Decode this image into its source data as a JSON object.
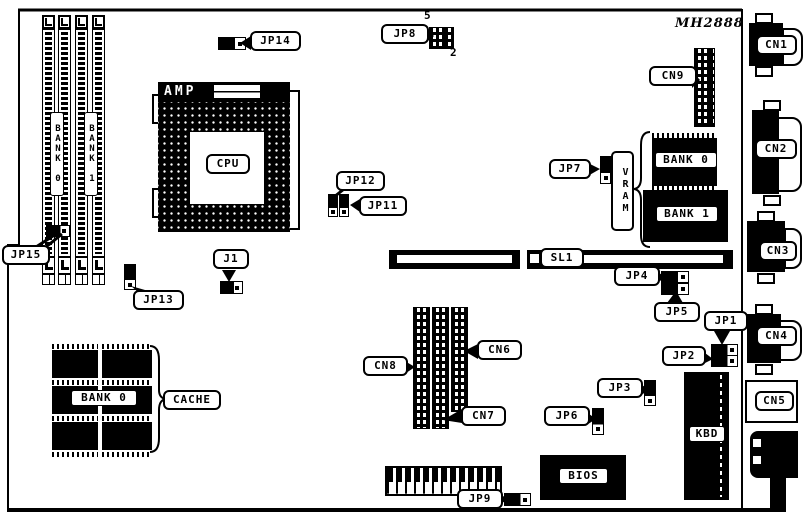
{
  "board": {
    "part_number": "MH2888",
    "cpu": {
      "socket_maker": "AMP",
      "label": "CPU"
    },
    "simm": {
      "bank0": "BANK 0",
      "bank1": "BANK 1"
    },
    "vram": {
      "label": "VRAM",
      "bank0": "BANK 0",
      "bank1": "BANK 1"
    },
    "cache": {
      "label": "CACHE",
      "bank0": "BANK 0"
    },
    "bios_label": "BIOS",
    "kbd_label": "KBD",
    "slot_label": "SL1",
    "jumpers": {
      "j1": "J1",
      "jp1": "JP1",
      "jp2": "JP2",
      "jp3": "JP3",
      "jp4": "JP4",
      "jp5": "JP5",
      "jp6": "JP6",
      "jp7": "JP7",
      "jp8": "JP8",
      "jp9": "JP9",
      "jp11": "JP11",
      "jp12": "JP12",
      "jp13": "JP13",
      "jp14": "JP14",
      "jp15": "JP15"
    },
    "jp8_pin_numbers": {
      "pin5": "5",
      "pin2": "2"
    },
    "connectors": {
      "cn1": "CN1",
      "cn2": "CN2",
      "cn3": "CN3",
      "cn4": "CN4",
      "cn5": "CN5",
      "cn6": "CN6",
      "cn7": "CN7",
      "cn8": "CN8",
      "cn9": "CN9"
    }
  }
}
